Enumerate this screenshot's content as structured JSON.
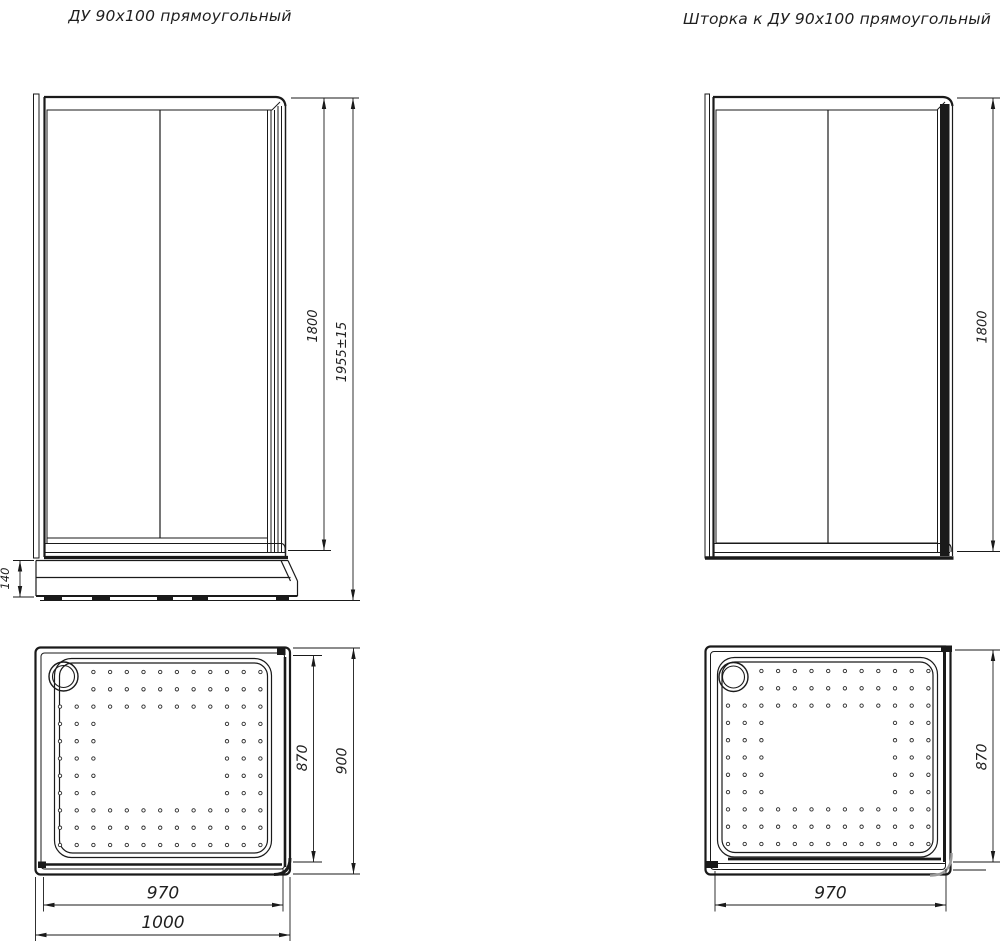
{
  "titles": {
    "enclosure": "ДУ 90x100 прямоугольный",
    "screen": "Шторка к ДУ 90x100 прямоугольный"
  },
  "enclosure_front": {
    "height_glass": "1800",
    "height_total": "1955±15",
    "tray_height": "140"
  },
  "screen_front": {
    "height_glass": "1800"
  },
  "enclosure_top": {
    "depth_inner": "870",
    "depth_outer": "900",
    "width_inner": "970",
    "width_outer": "1000"
  },
  "screen_top": {
    "depth_inner": "870",
    "width_inner": "970"
  },
  "colors": {
    "line": "#1a1a1a",
    "background": "#ffffff"
  }
}
